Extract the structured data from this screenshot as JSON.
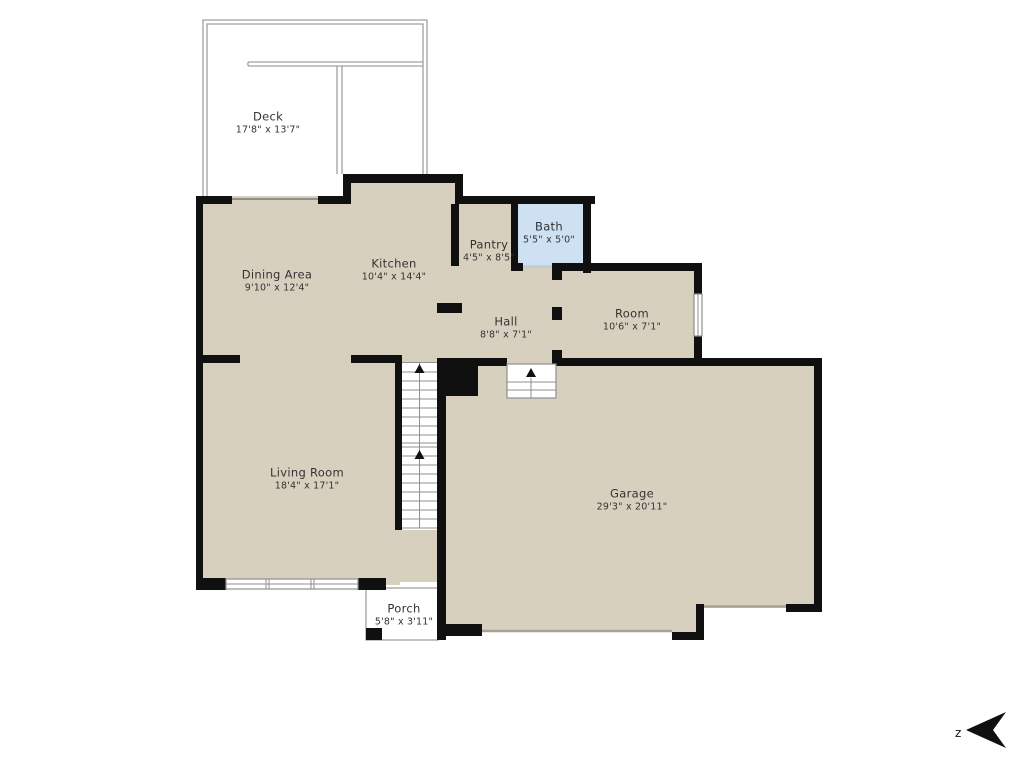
{
  "rooms": {
    "deck": {
      "name": "Deck",
      "dims": "17'8\" x 13'7\""
    },
    "dining": {
      "name": "Dining Area",
      "dims": "9'10\" x 12'4\""
    },
    "kitchen": {
      "name": "Kitchen",
      "dims": "10'4\" x 14'4\""
    },
    "pantry": {
      "name": "Pantry",
      "dims": "4'5\" x 8'5\""
    },
    "bath": {
      "name": "Bath",
      "dims": "5'5\" x 5'0\""
    },
    "hall": {
      "name": "Hall",
      "dims": "8'8\" x 7'1\""
    },
    "room": {
      "name": "Room",
      "dims": "10'6\" x 7'1\""
    },
    "living": {
      "name": "Living Room",
      "dims": "18'4\" x 17'1\""
    },
    "garage": {
      "name": "Garage",
      "dims": "29'3\" x 20'11\""
    },
    "porch": {
      "name": "Porch",
      "dims": "5'8\" x 3'11\""
    }
  },
  "compass": {
    "label": "z"
  },
  "colors": {
    "floor": "#d8d0bf",
    "bath_floor": "#cde1f2",
    "wall": "#101010",
    "thin_line": "#8f8f8f",
    "outline": "#a0a0a0",
    "garage_door": "#a9a294",
    "text": "#333333"
  }
}
